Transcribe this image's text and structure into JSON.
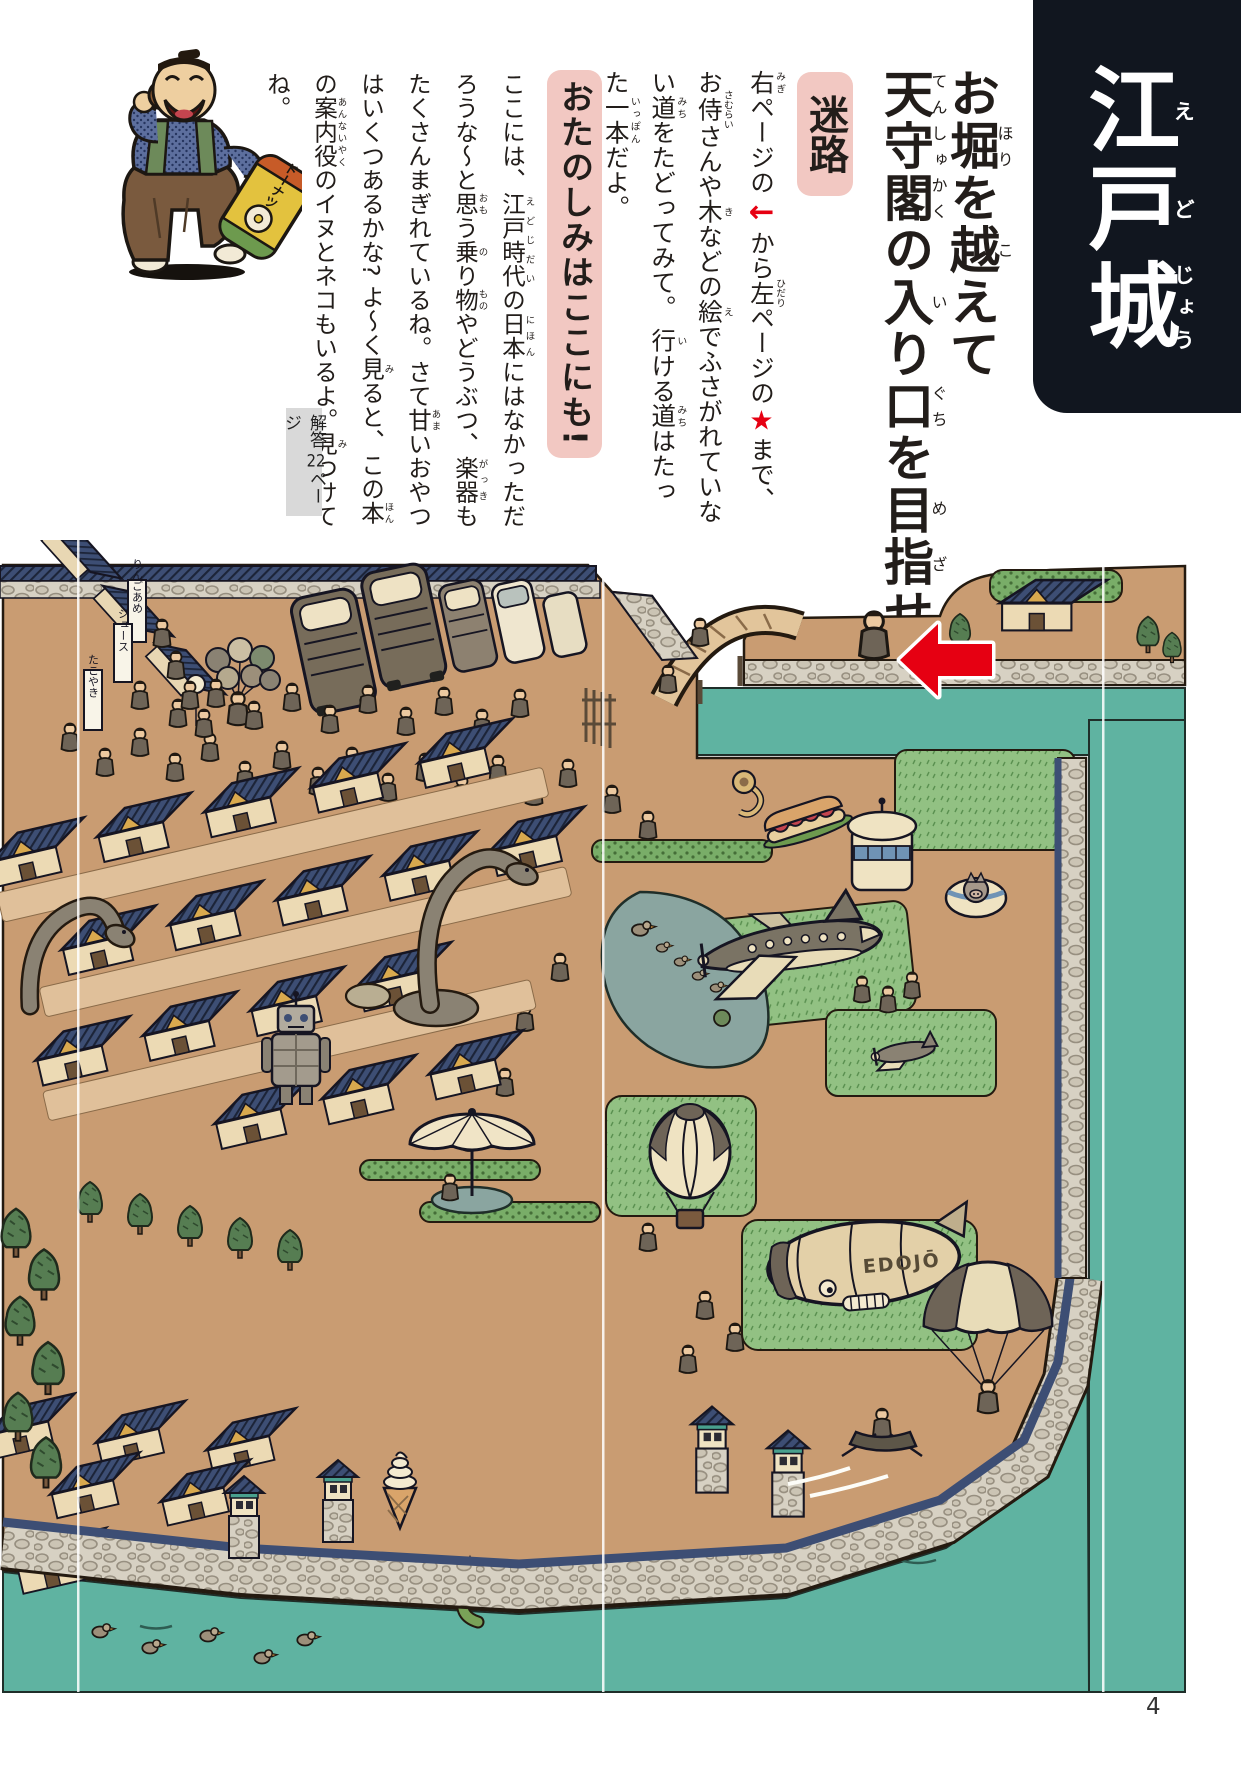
{
  "page": {
    "number": "4"
  },
  "banner": {
    "title": [
      {
        "t": "江",
        "r": "え"
      },
      {
        "t": "戸",
        "r": "ど"
      },
      {
        "t": "城",
        "r": "じょう"
      }
    ]
  },
  "header": {
    "title": [
      {
        "t": "お"
      },
      {
        "t": "堀",
        "r": "ほり"
      },
      {
        "t": "を"
      },
      {
        "t": "越",
        "r": "こ"
      },
      {
        "t": "えて"
      },
      {
        "br": true
      },
      {
        "t": "天守閣",
        "r": "てんしゅかく"
      },
      {
        "t": "の"
      },
      {
        "t": "入",
        "r": "い"
      },
      {
        "t": "り"
      },
      {
        "t": "口",
        "r": "ぐち"
      },
      {
        "t": "を"
      },
      {
        "t": "目指",
        "r": "めざ"
      },
      {
        "t": "せ"
      }
    ],
    "maze_label": "迷路",
    "maze_text": [
      {
        "t": "右",
        "r": "みぎ"
      },
      {
        "t": "ページの"
      },
      {
        "t": "←",
        "c": "seg-arrow"
      },
      {
        "t": "から"
      },
      {
        "t": "左",
        "r": "ひだり"
      },
      {
        "t": "ページの"
      },
      {
        "t": "★",
        "c": "seg-star"
      },
      {
        "t": "まで、お"
      },
      {
        "t": "侍",
        "r": "さむらい"
      },
      {
        "t": "さんや"
      },
      {
        "t": "木",
        "r": "き"
      },
      {
        "t": "などの"
      },
      {
        "t": "絵",
        "r": "え"
      },
      {
        "t": "でふさがれていない"
      },
      {
        "t": "道",
        "r": "みち"
      },
      {
        "t": "をたどってみて。 "
      },
      {
        "t": "行",
        "r": "い"
      },
      {
        "t": "ける"
      },
      {
        "t": "道",
        "r": "みち"
      },
      {
        "t": "はたった"
      },
      {
        "t": "一本",
        "r": "いっぽん"
      },
      {
        "t": "だよ。"
      }
    ],
    "fun_label": "おたのしみはここにも!",
    "fun_text": [
      {
        "t": "ここには、"
      },
      {
        "t": "江戸時代",
        "r": "えどじだい"
      },
      {
        "t": "の"
      },
      {
        "t": "日本",
        "r": "にほん"
      },
      {
        "t": "にはなかっただろうな〜と"
      },
      {
        "t": "思",
        "r": "おも"
      },
      {
        "t": "う"
      },
      {
        "t": "乗",
        "r": "の"
      },
      {
        "t": "り"
      },
      {
        "t": "物",
        "r": "もの"
      },
      {
        "t": "やどうぶつ、"
      },
      {
        "t": "楽器",
        "r": "がっき"
      },
      {
        "t": "もたくさんまぎれているね。さて"
      },
      {
        "t": "甘",
        "r": "あま"
      },
      {
        "t": "いおやつはいくつあるかな? よ〜く"
      },
      {
        "t": "見",
        "r": "み"
      },
      {
        "t": "ると、この"
      },
      {
        "t": "本",
        "r": "ほん"
      },
      {
        "t": "の"
      },
      {
        "t": "案内役",
        "r": "あんないやく"
      },
      {
        "t": "のイヌとネコもいるよ。"
      },
      {
        "t": "見",
        "r": "み"
      },
      {
        "t": "つけてね。"
      }
    ],
    "answer_note": [
      {
        "t": "解答 "
      },
      {
        "t": "22",
        "c": "tcy"
      },
      {
        "t": "ページ"
      }
    ]
  },
  "mascot": {
    "box_label": "ドーナツ"
  },
  "scene": {
    "blimp_label": "EDOJŌ",
    "stall_signs": [
      "りんごあめ",
      "ジュース",
      "たこやき"
    ]
  },
  "colors": {
    "banner_bg": "#11161f",
    "badge_pink": "#f2c8c2",
    "accent_red": "#e60012",
    "water_teal": "#5fb3a1",
    "ground_tan": "#c99c72",
    "roof_indigo": "#3d4e74"
  }
}
